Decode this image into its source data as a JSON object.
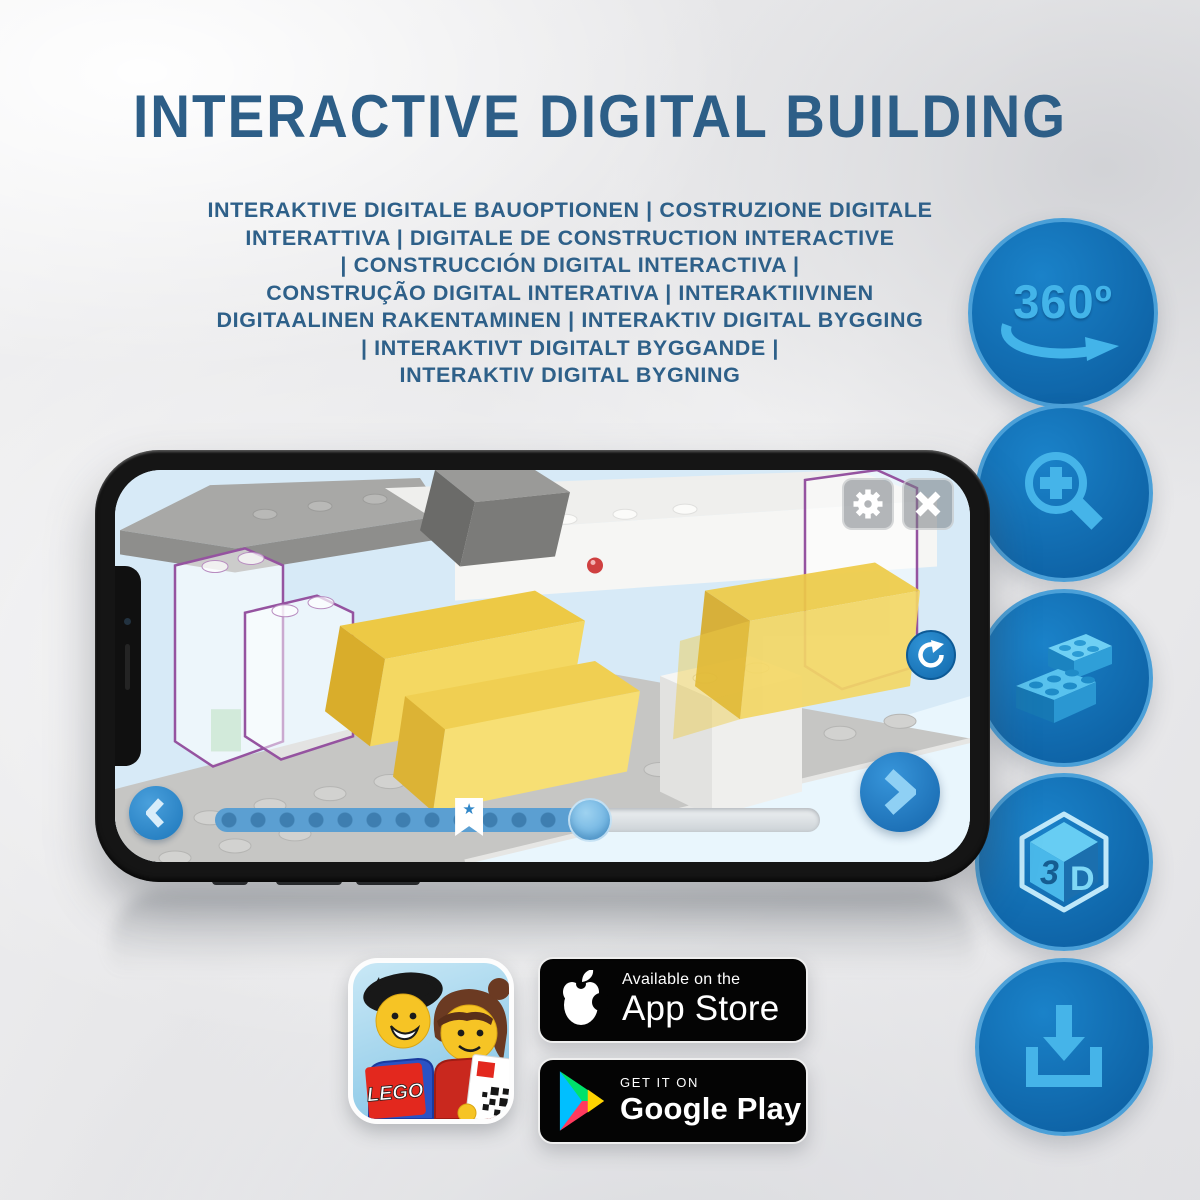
{
  "header": {
    "title": "INTERACTIVE DIGITAL BUILDING"
  },
  "subtitle": {
    "lines": [
      "INTERAKTIVE DIGITALE BAUOPTIONEN | COSTRUZIONE DIGITALE",
      "INTERATTIVA | DIGITALE DE CONSTRUCTION INTERACTIVE",
      "| CONSTRUCCIÓN DIGITAL INTERACTIVA |",
      "CONSTRUÇÃO DIGITAL INTERATIVA | INTERAKTIIVINEN",
      "DIGITAALINEN RAKENTAMINEN | INTERAKTIV DIGITAL BYGGING",
      "| INTERAKTIVT DIGITALT BYGGANDE |",
      "INTERAKTIV DIGITAL BYGNING"
    ]
  },
  "features": {
    "rotate360": {
      "label": "360º",
      "icon": "rotate-360-icon"
    },
    "zoom": {
      "icon": "zoom-in-magnifier-icon"
    },
    "bricks": {
      "icon": "lego-bricks-icon"
    },
    "cube3d": {
      "label_three": "3",
      "label_d": "D",
      "icon": "3d-cube-icon"
    },
    "download": {
      "icon": "download-icon"
    }
  },
  "phone": {
    "slider": {
      "fill_style": "width:62%",
      "bookmark_style": "left:42%",
      "thumb_style": "left:62%",
      "star_glyph": "★"
    }
  },
  "badges": {
    "app_store": {
      "tagline": "Available on the",
      "store_name": "App Store"
    },
    "google_play": {
      "tagline": "GET IT ON",
      "store_name": "Google Play"
    }
  },
  "app_icon": {
    "brand": "LEGO"
  },
  "colors": {
    "title_blue": "#2d5e87",
    "circle_blue": "#1072b8",
    "circle_rim": "#4ba0d8",
    "glyph_blue": "#45b4e9",
    "ui_button_blue": "#2a8fd6",
    "slider_fill": "#5b9fd2",
    "brick_yellow": "#f1cd49",
    "ghost_outline_purple": "#9553a0",
    "play_green": "#00e26b",
    "play_cyan": "#00bfff",
    "play_yellow": "#ffd400",
    "play_red": "#ff3a5e",
    "lego_red": "#e3281e"
  }
}
